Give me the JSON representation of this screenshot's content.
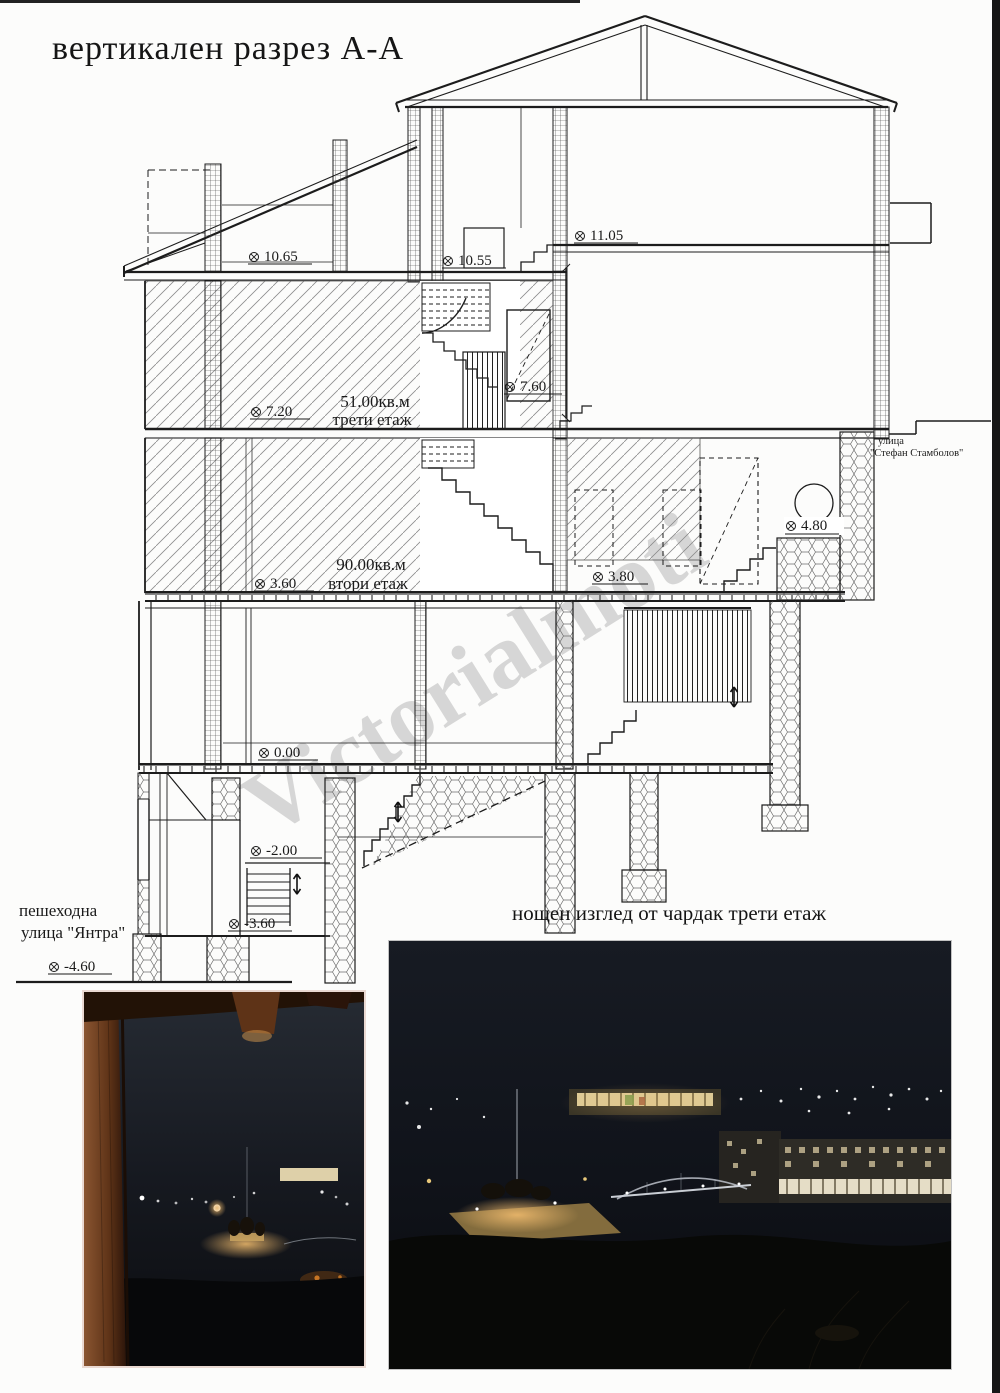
{
  "page": {
    "title": "вертикален разрез А-А"
  },
  "drawing": {
    "levels": [
      {
        "value": "10.65"
      },
      {
        "value": "10.55"
      },
      {
        "value": "11.05"
      },
      {
        "value": "7.20"
      },
      {
        "value": "7.60"
      },
      {
        "value": "3.60"
      },
      {
        "value": "3.80"
      },
      {
        "value": "4.80"
      },
      {
        "value": "0.00"
      },
      {
        "value": "-2.00"
      },
      {
        "value": "-3.60"
      },
      {
        "value": "-4.60"
      }
    ],
    "rooms": [
      {
        "area": "51.00кв.м",
        "name": "трети етаж"
      },
      {
        "area": "90.00кв.м",
        "name": "втори етаж"
      }
    ],
    "street_right": {
      "line1": "улица",
      "line2": "\"Стефан Стамболов\""
    },
    "street_left": {
      "line1": "пешеходна",
      "line2": "улица \"Янтра\""
    },
    "watermark": "Victorialmoti"
  },
  "photos": {
    "caption": "нощен изглед от чардак трети етаж"
  }
}
